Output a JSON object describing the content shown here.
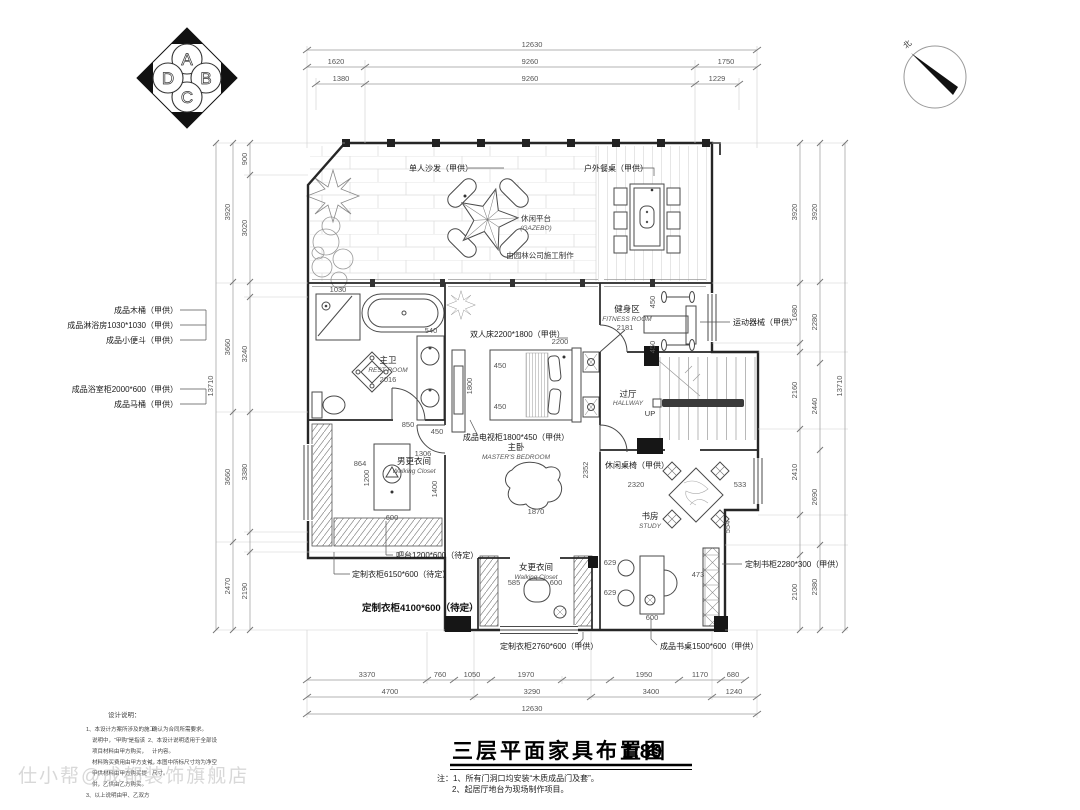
{
  "title_block": {
    "title": "三层平面家具布置图",
    "scale": "1:80",
    "notes": [
      "注：1、所有门洞口均安装“木质成品门及套”。",
      "2、起居厅地台为现场制作项目。"
    ]
  },
  "logo": {
    "letters": [
      "A",
      "B",
      "C",
      "D"
    ]
  },
  "compass": {
    "north": "北"
  },
  "watermark": {
    "text": "仕小帮@成都装饰旗舰店"
  },
  "design_notes": {
    "title": "设计说明：",
    "col1": [
      "1、本设计方案所涉及的施工",
      "说明中，“甲购”是指该",
      "项目材料由甲方购买，",
      "材料购买费用由甲方支付，",
      "甲供材料由甲方购买提",
      "供，乙供由乙方购买。",
      "3、以上说明由甲、乙双方"
    ],
    "col2": [
      "确认为合同所需要求。",
      "2、本设计说明适用于全部设",
      "计内容。",
      "4、本图中所标尺寸均为净空",
      "尺寸。"
    ]
  },
  "dims": {
    "top_overall": "12630",
    "top_row2": [
      "1620",
      "9260",
      "1750"
    ],
    "top_row3": [
      "1380",
      "9260",
      "1229"
    ],
    "bottom_row1": [
      "3370",
      "760",
      "1050",
      "1970",
      "1950",
      "1170",
      "680"
    ],
    "bottom_row2": [
      "4700",
      "3290",
      "3400",
      "1240"
    ],
    "bottom_overall": "12630",
    "left_overall": "13710",
    "left_outer": [
      "3920",
      "3660",
      "3660",
      "2470"
    ],
    "left_inner": [
      "900",
      "3020",
      "3240",
      "3380",
      "2190"
    ],
    "right_overall": "13710",
    "right_mid": [
      "3920",
      "2280",
      "2440",
      "2690",
      "2380"
    ],
    "right_inner": [
      "3920",
      "1680",
      "2160",
      "2410",
      "2100"
    ]
  },
  "callouts": {
    "left": [
      "成品木桶（甲供）",
      "成品淋浴房1030*1030（甲供）",
      "成品小便斗（甲供）",
      "成品浴室柜2000*600（甲供）",
      "成品马桶（甲供）"
    ],
    "right": [
      "定制书柜2280*300（甲供）"
    ],
    "bottom": [
      "吧台1200*600（待定）",
      "定制衣柜6150*600（待定）",
      "定制衣柜4100*600（待定）",
      "定制衣柜2760*600（甲供）",
      "成品书桌1500*600（甲供）"
    ]
  },
  "plan_labels": {
    "sofa": "单人沙发（甲供）",
    "outdoor_table": "户外餐桌（甲供）",
    "gazebo_cn": "休闲平台",
    "gazebo_en": "(GAZEBO)",
    "landscape_note": "由园林公司施工制作",
    "bed": "双人床2200*1800（甲供）",
    "tv_cabinet": "成品电视柜1800*450（甲供）",
    "equipment": "运动器械（甲供）",
    "leisure_set": "休闲桌椅（甲供）",
    "rooms": {
      "bath_cn": "主卫",
      "bath_en": "REST ROOM",
      "fitness_cn": "健身区",
      "fitness_en": "FITNESS ROOM",
      "hall_cn": "过厅",
      "hall_en": "HALLWAY",
      "up": "UP",
      "master_cn": "主卧",
      "master_en": "MASTER'S BEDROOM",
      "closet_m_cn": "男更衣间",
      "closet_m_en": "Walking Closet",
      "closet_f_cn": "女更衣间",
      "closet_f_en": "Walking Closet",
      "study_cn": "书房",
      "study_en": "STUDY"
    }
  },
  "inner_dims": {
    "bath": [
      "1030",
      "2016",
      "850",
      "540"
    ],
    "bed": [
      "2200",
      "450",
      "450",
      "1800"
    ],
    "bedroom": [
      "1870",
      "2352"
    ],
    "fitness": [
      "2181",
      "450",
      "450"
    ],
    "closet_m": [
      "864",
      "1200",
      "600",
      "1306",
      "1400",
      "450"
    ],
    "closet_f": [
      "585",
      "600"
    ],
    "study": [
      "2320",
      "533",
      "554"
    ],
    "desk": [
      "629",
      "629",
      "473",
      "600"
    ]
  }
}
